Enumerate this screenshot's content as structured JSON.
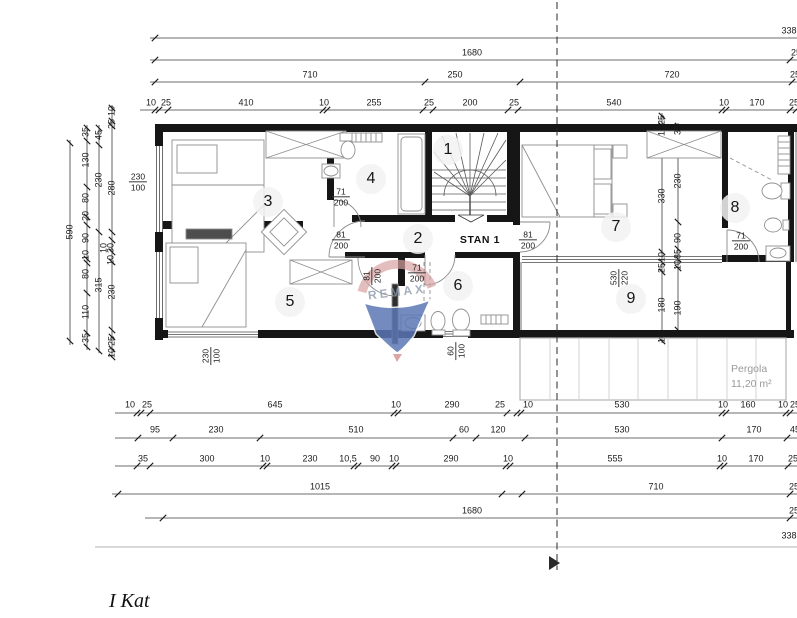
{
  "title": {
    "text": "I Kat"
  },
  "plan": {
    "apartment_label": "STAN 1",
    "watermark_text": "REMAX",
    "pergola": {
      "name": "Pergola",
      "area": "11,20 m²"
    },
    "rooms": [
      {
        "num": "1",
        "x": 448,
        "y": 150
      },
      {
        "num": "2",
        "x": 418,
        "y": 239
      },
      {
        "num": "3",
        "x": 268,
        "y": 202
      },
      {
        "num": "4",
        "x": 371,
        "y": 179
      },
      {
        "num": "5",
        "x": 290,
        "y": 302
      },
      {
        "num": "6",
        "x": 458,
        "y": 286
      },
      {
        "num": "7",
        "x": 616,
        "y": 227
      },
      {
        "num": "8",
        "x": 735,
        "y": 208
      },
      {
        "num": "9",
        "x": 631,
        "y": 299
      }
    ],
    "door_labels": [
      {
        "top": "71",
        "bottom": "200",
        "x": 341,
        "y": 197,
        "v": false
      },
      {
        "top": "81",
        "bottom": "200",
        "x": 341,
        "y": 240,
        "v": false
      },
      {
        "top": "81",
        "bottom": "200",
        "x": 528,
        "y": 240,
        "v": false
      },
      {
        "top": "71",
        "bottom": "200",
        "x": 417,
        "y": 273,
        "v": false
      },
      {
        "top": "71",
        "bottom": "200",
        "x": 741,
        "y": 241,
        "v": false
      },
      {
        "top": "81",
        "bottom": "200",
        "x": 372,
        "y": 276,
        "v": true
      }
    ],
    "window_labels": [
      {
        "top": "230",
        "bottom": "100",
        "x": 138,
        "y": 182,
        "v": false
      },
      {
        "top": "230",
        "bottom": "100",
        "x": 211,
        "y": 356,
        "v": true
      },
      {
        "top": "60",
        "bottom": "100",
        "x": 456,
        "y": 351,
        "v": true
      },
      {
        "top": "530",
        "bottom": "220",
        "x": 619,
        "y": 278,
        "v": true
      }
    ]
  },
  "dims": {
    "top_rows": [
      {
        "y": 31,
        "labels": [
          {
            "t": "338",
            "x": 789
          }
        ]
      },
      {
        "y": 53,
        "labels": [
          {
            "t": "1680",
            "x": 472
          },
          {
            "t": "25",
            "x": 796
          }
        ]
      },
      {
        "y": 75,
        "labels": [
          {
            "t": "710",
            "x": 310
          },
          {
            "t": "250",
            "x": 455
          },
          {
            "t": "720",
            "x": 672
          },
          {
            "t": "25",
            "x": 795
          }
        ]
      },
      {
        "y": 103,
        "labels": [
          {
            "t": "10",
            "x": 151
          },
          {
            "t": "25",
            "x": 166
          },
          {
            "t": "410",
            "x": 246
          },
          {
            "t": "10",
            "x": 324
          },
          {
            "t": "255",
            "x": 374
          },
          {
            "t": "25",
            "x": 429
          },
          {
            "t": "200",
            "x": 470
          },
          {
            "t": "25",
            "x": 514
          },
          {
            "t": "540",
            "x": 614
          },
          {
            "t": "10",
            "x": 724
          },
          {
            "t": "170",
            "x": 757
          },
          {
            "t": "25",
            "x": 794
          }
        ]
      }
    ],
    "bottom_rows": [
      {
        "y": 405,
        "labels": [
          {
            "t": "10",
            "x": 130
          },
          {
            "t": "25",
            "x": 147
          },
          {
            "t": "645",
            "x": 275
          },
          {
            "t": "10",
            "x": 396
          },
          {
            "t": "290",
            "x": 452
          },
          {
            "t": "25",
            "x": 500
          },
          {
            "t": "10",
            "x": 528
          },
          {
            "t": "530",
            "x": 622
          },
          {
            "t": "10",
            "x": 723
          },
          {
            "t": "160",
            "x": 748
          },
          {
            "t": "10",
            "x": 783
          },
          {
            "t": "25",
            "x": 795
          }
        ]
      },
      {
        "y": 430,
        "labels": [
          {
            "t": "95",
            "x": 155
          },
          {
            "t": "230",
            "x": 216
          },
          {
            "t": "510",
            "x": 356
          },
          {
            "t": "60",
            "x": 464
          },
          {
            "t": "120",
            "x": 498
          },
          {
            "t": "530",
            "x": 622
          },
          {
            "t": "170",
            "x": 754
          },
          {
            "t": "45",
            "x": 795
          }
        ]
      },
      {
        "y": 459,
        "labels": [
          {
            "t": "35",
            "x": 143
          },
          {
            "t": "300",
            "x": 207
          },
          {
            "t": "10",
            "x": 265
          },
          {
            "t": "230",
            "x": 310
          },
          {
            "t": "10,5",
            "x": 348
          },
          {
            "t": "90",
            "x": 375
          },
          {
            "t": "10",
            "x": 394
          },
          {
            "t": "290",
            "x": 451
          },
          {
            "t": "10",
            "x": 508
          },
          {
            "t": "555",
            "x": 615
          },
          {
            "t": "10",
            "x": 722
          },
          {
            "t": "170",
            "x": 756
          },
          {
            "t": "25",
            "x": 793
          }
        ]
      },
      {
        "y": 487,
        "labels": [
          {
            "t": "1015",
            "x": 320
          },
          {
            "t": "710",
            "x": 656
          },
          {
            "t": "25",
            "x": 794
          }
        ]
      },
      {
        "y": 511,
        "labels": [
          {
            "t": "1680",
            "x": 472
          },
          {
            "t": "25",
            "x": 794
          }
        ]
      },
      {
        "y": 536,
        "labels": [
          {
            "t": "338",
            "x": 789
          }
        ]
      }
    ],
    "left_cols": [
      {
        "t": "590",
        "x": 70,
        "y": 232
      },
      {
        "t": "35",
        "x": 86,
        "y": 132
      },
      {
        "t": "130",
        "x": 86,
        "y": 160
      },
      {
        "t": "80",
        "x": 86,
        "y": 198
      },
      {
        "t": "20",
        "x": 86,
        "y": 216
      },
      {
        "t": "90",
        "x": 86,
        "y": 238
      },
      {
        "t": "10",
        "x": 86,
        "y": 255
      },
      {
        "t": "80",
        "x": 86,
        "y": 274
      },
      {
        "t": "110",
        "x": 86,
        "y": 312
      },
      {
        "t": "35",
        "x": 86,
        "y": 338
      },
      {
        "t": "45",
        "x": 99,
        "y": 135
      },
      {
        "t": "230",
        "x": 99,
        "y": 180
      },
      {
        "t": "315",
        "x": 99,
        "y": 285
      },
      {
        "t": "10",
        "x": 112,
        "y": 111
      },
      {
        "t": "25",
        "x": 112,
        "y": 124
      },
      {
        "t": "280",
        "x": 112,
        "y": 188
      },
      {
        "t": "10",
        "x": 104,
        "y": 248
      },
      {
        "t": "30",
        "x": 111,
        "y": 248
      },
      {
        "t": "10",
        "x": 111,
        "y": 260
      },
      {
        "t": "230",
        "x": 112,
        "y": 292
      },
      {
        "t": "25",
        "x": 112,
        "y": 341
      },
      {
        "t": "10",
        "x": 112,
        "y": 353
      }
    ],
    "right_cols": [
      {
        "t": "25",
        "x": 662,
        "y": 120
      },
      {
        "t": "10",
        "x": 662,
        "y": 131
      },
      {
        "t": "330",
        "x": 662,
        "y": 196
      },
      {
        "t": "10",
        "x": 662,
        "y": 257
      },
      {
        "t": "25",
        "x": 662,
        "y": 268
      },
      {
        "t": "180",
        "x": 662,
        "y": 305
      },
      {
        "t": "10",
        "x": 662,
        "y": 338
      },
      {
        "t": "35",
        "x": 678,
        "y": 130
      },
      {
        "t": "230",
        "x": 678,
        "y": 181
      },
      {
        "t": "90",
        "x": 678,
        "y": 238
      },
      {
        "t": "35",
        "x": 678,
        "y": 254
      },
      {
        "t": "10",
        "x": 678,
        "y": 265
      },
      {
        "t": "190",
        "x": 678,
        "y": 308
      }
    ]
  }
}
